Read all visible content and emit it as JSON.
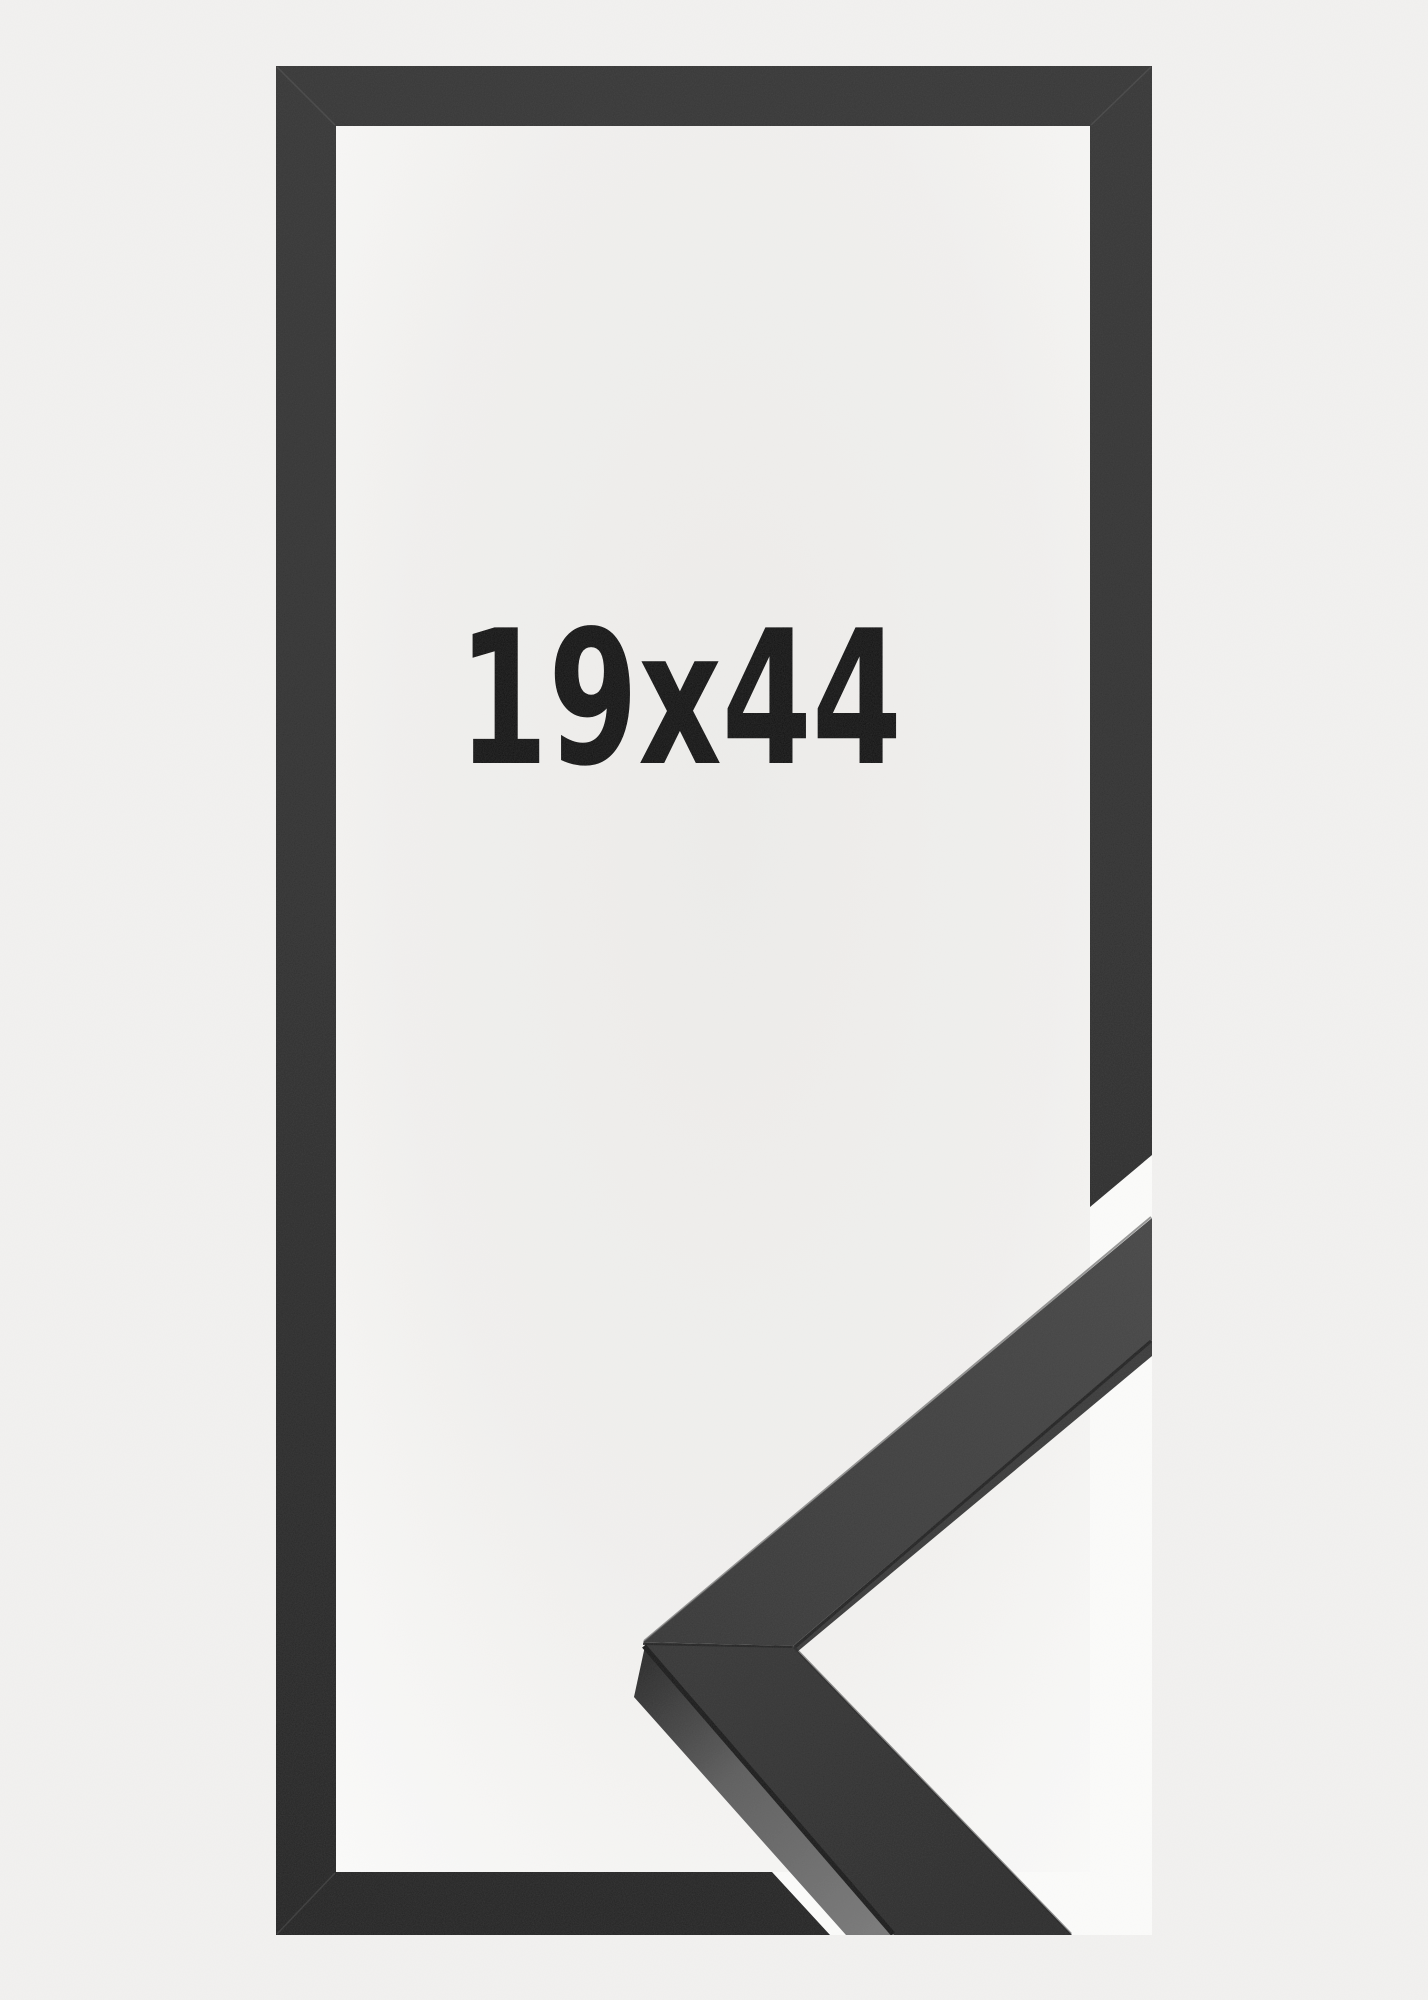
{
  "product_image": {
    "size_label": "19x44",
    "colors": {
      "background": "#f2f1f0",
      "interior_center": "#edecea",
      "interior_edge": "#fbfbfa",
      "cutout_gap": "#fbfbfa",
      "frame_dark": "#2f2f2f",
      "sample_face": "#3e3e3e",
      "sample_side": "#6e6e6e",
      "label_text": "#0c0c0c"
    }
  }
}
